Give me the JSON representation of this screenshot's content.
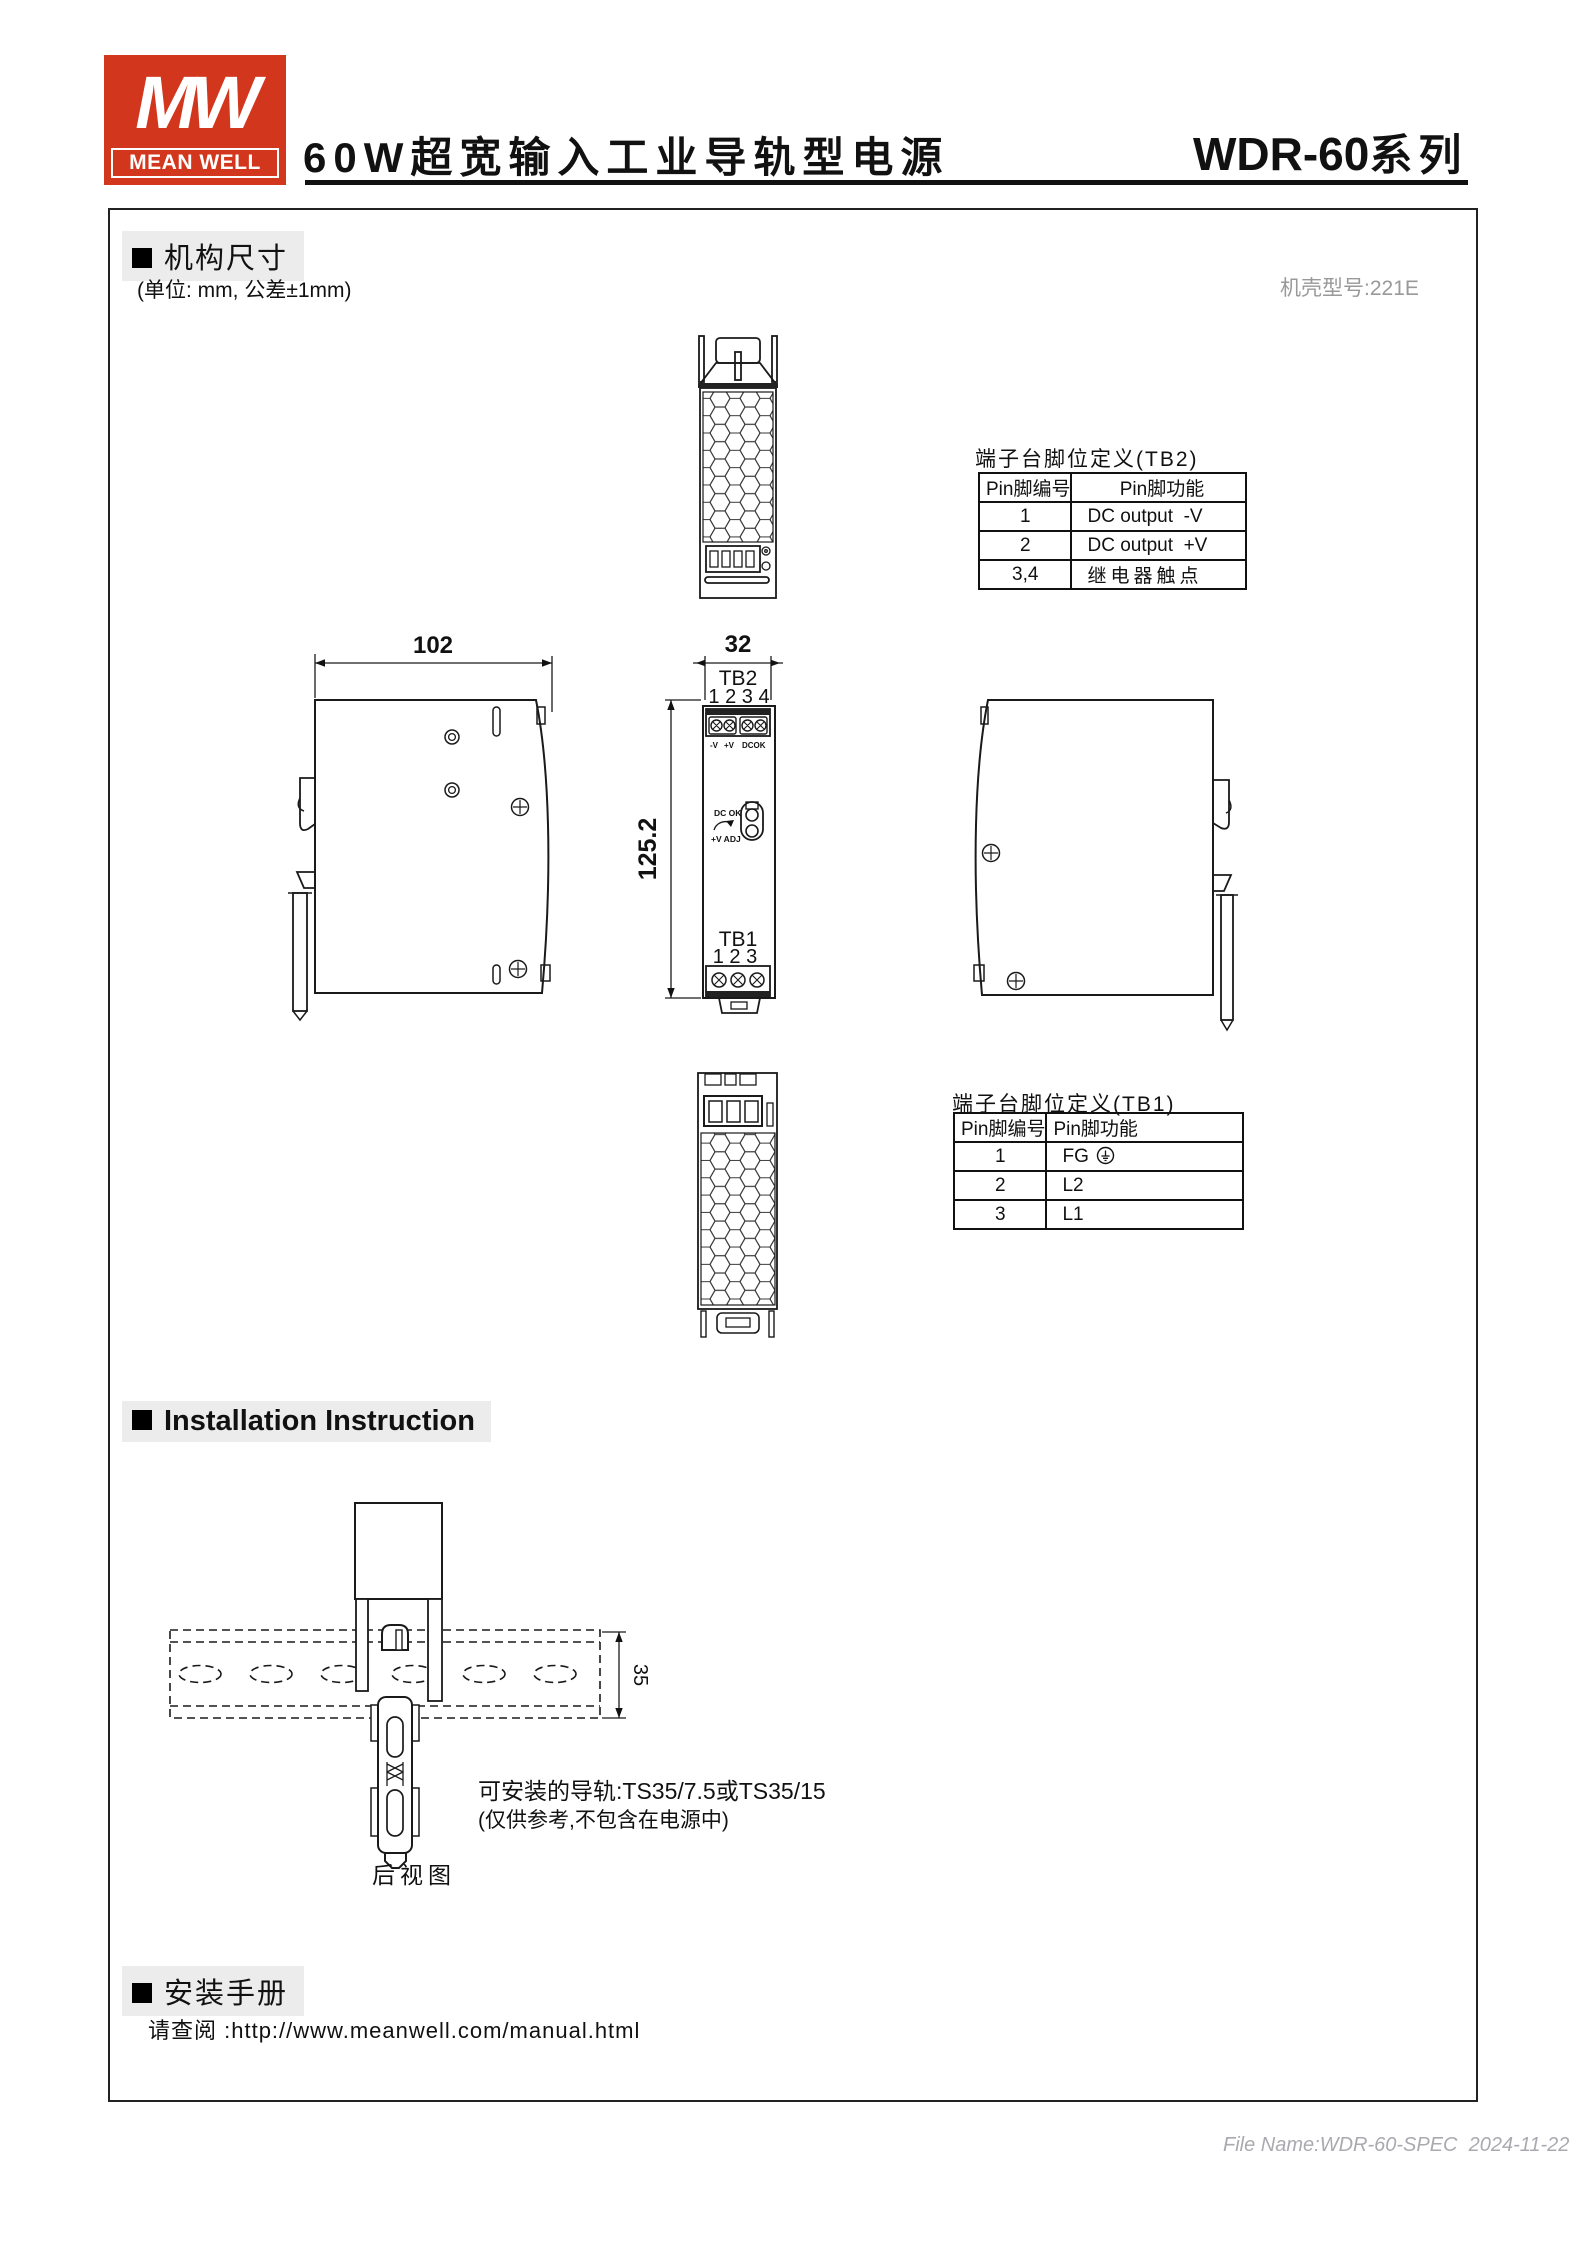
{
  "header": {
    "logo_mw": "MW",
    "logo_brand": "MEAN WELL",
    "brand_red": "#d2361c",
    "title": "60W超宽输入工业导轨型电源",
    "series_name": "WDR-60",
    "series_suffix": "系列"
  },
  "mech_section": {
    "heading": "机构尺寸",
    "unit_note": "(单位: mm, 公差±1mm)",
    "case_note": "机壳型号:221E",
    "dim_width": "102",
    "dim_depth": "32",
    "dim_height": "125.2",
    "front_labels": {
      "tb2": "TB2",
      "tb2_pins": "1 2 3 4",
      "mark_neg": "-V",
      "mark_pos": "+V",
      "mark_dcok": "DCOK",
      "dc_ok": "DC OK",
      "v_adj": "+V ADJ",
      "tb1": "TB1",
      "tb1_pins": "1 2 3"
    },
    "tb2_table": {
      "title": "端子台脚位定义(TB2)",
      "col_pin": "Pin脚编号",
      "col_func": "Pin脚功能",
      "rows": [
        {
          "pin": "1",
          "func": "DC output  -V"
        },
        {
          "pin": "2",
          "func": "DC output  +V"
        },
        {
          "pin": "3,4",
          "func": "继电器触点"
        }
      ]
    },
    "tb1_table": {
      "title": "端子台脚位定义(TB1)",
      "col_pin": "Pin脚编号",
      "col_func": "Pin脚功能",
      "rows": [
        {
          "pin": "1",
          "func": "FG"
        },
        {
          "pin": "2",
          "func": "L2"
        },
        {
          "pin": "3",
          "func": "L1"
        }
      ]
    }
  },
  "install_section": {
    "heading": "Installation Instruction",
    "rail_height": "35",
    "rail_note": "可安装的导轨:TS35/7.5或TS35/15",
    "rail_note_sub": "(仅供参考,不包含在电源中)",
    "rear_view_caption": "后视图"
  },
  "manual_section": {
    "heading": "安装手册",
    "prompt": "请查阅 :",
    "url": "http://www.meanwell.com/manual.html"
  },
  "footer": {
    "file_info": "File Name:WDR-60-SPEC  2024-11-22"
  }
}
